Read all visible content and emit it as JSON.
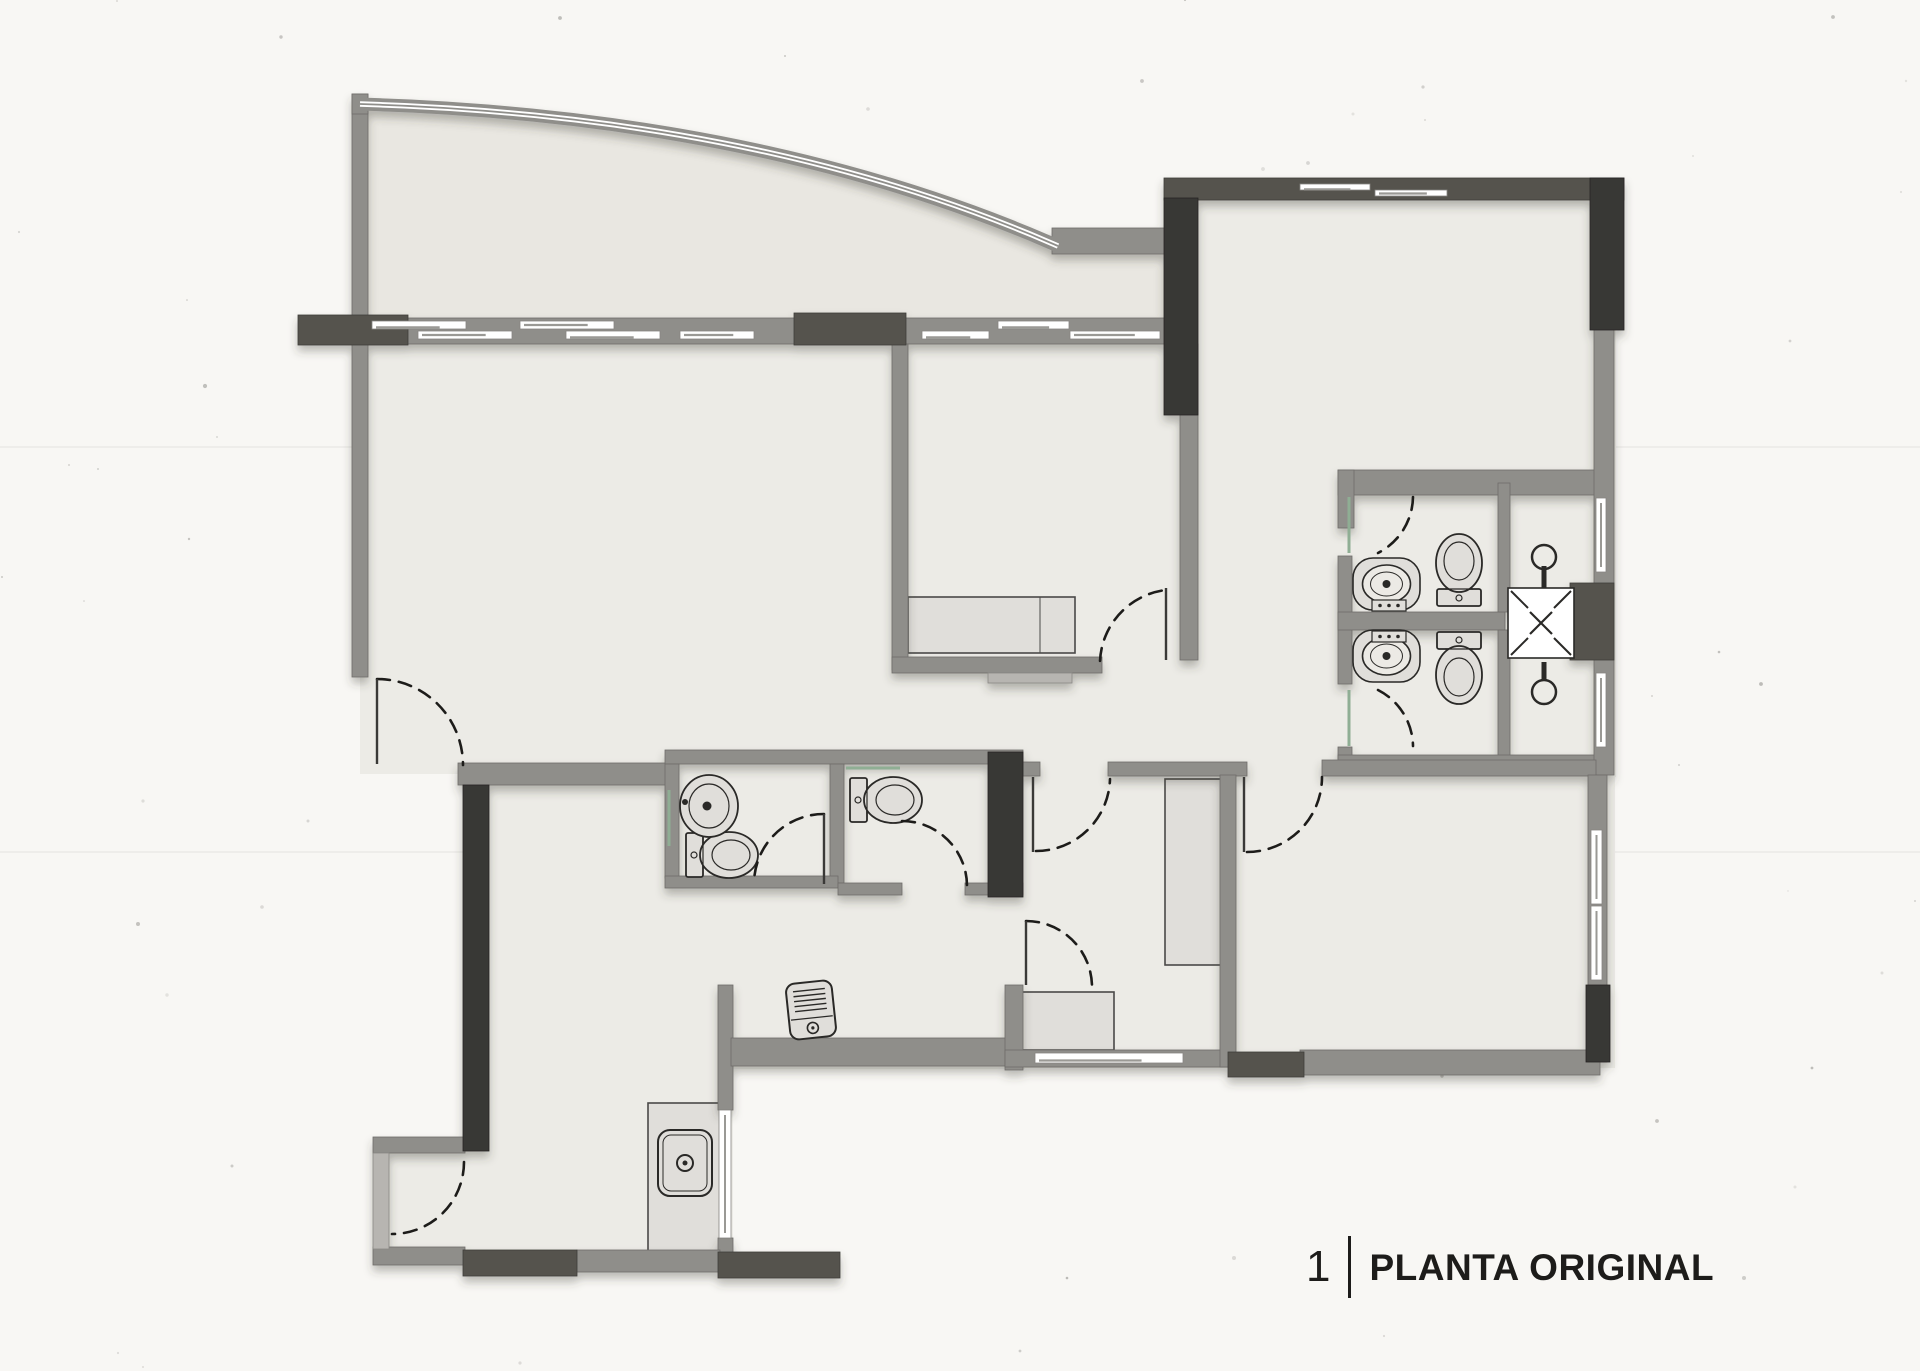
{
  "title": {
    "number": "1",
    "label": "PLANTA ORIGINAL"
  },
  "palette": {
    "paper": "#f8f7f4",
    "floor": "#ecebe6",
    "floor2": "#e9e7e1",
    "wallMid": "#8f8e8a",
    "wallLight": "#b7b5b1",
    "wallDark": "#54524e",
    "wallXDark": "#393834",
    "ink": "#2a2927",
    "furn": "#e0deda",
    "furnLine": "#4a4948",
    "glass": "#8fae94",
    "white": "#ffffff"
  },
  "texture": {
    "speckles": 90,
    "seed": 7,
    "streak_ys": [
      447,
      852
    ]
  },
  "plan": {
    "floors": {
      "terrace_path": "M 360,102 Q 762,114 1056,244 L 1164,244 L 1164,344 L 360,344 Z",
      "rects": [
        [
          360,
          330,
          840,
          444
        ],
        [
          1164,
          198,
          452,
          302
        ],
        [
          1180,
          480,
          436,
          297
        ],
        [
          465,
          757,
          560,
          312
        ],
        [
          465,
          1060,
          268,
          204
        ],
        [
          1023,
          762,
          592,
          306
        ],
        [
          373,
          1150,
          100,
          104
        ]
      ]
    },
    "curve": {
      "band": "M 360,104 Q 762,116 1058,246",
      "cap": [
        352,
        94,
        16,
        20
      ]
    },
    "walls": {
      "mid": [
        [
          352,
          94,
          16,
          230
        ],
        [
          1052,
          228,
          114,
          26
        ],
        [
          300,
          318,
          896,
          26
        ],
        [
          352,
          344,
          16,
          333
        ],
        [
          1180,
          344,
          18,
          316
        ],
        [
          1338,
          470,
          258,
          25
        ],
        [
          1338,
          470,
          16,
          58
        ],
        [
          1338,
          556,
          14,
          128
        ],
        [
          1338,
          747,
          14,
          12
        ],
        [
          1338,
          612,
          167,
          18
        ],
        [
          1498,
          483,
          12,
          129
        ],
        [
          1498,
          630,
          12,
          127
        ],
        [
          1338,
          755,
          268,
          20
        ],
        [
          1594,
          328,
          20,
          447
        ],
        [
          892,
          344,
          16,
          326
        ],
        [
          892,
          657,
          210,
          16
        ],
        [
          1023,
          762,
          17,
          14
        ],
        [
          1108,
          762,
          139,
          14
        ],
        [
          1322,
          760,
          274,
          16
        ],
        [
          458,
          763,
          216,
          22
        ],
        [
          665,
          750,
          358,
          14
        ],
        [
          665,
          764,
          14,
          114
        ],
        [
          830,
          764,
          14,
          119
        ],
        [
          665,
          876,
          173,
          12
        ],
        [
          838,
          883,
          64,
          12
        ],
        [
          965,
          883,
          58,
          12
        ],
        [
          718,
          985,
          15,
          125
        ],
        [
          718,
          1238,
          15,
          20
        ],
        [
          731,
          1038,
          276,
          28
        ],
        [
          1005,
          985,
          18,
          85
        ],
        [
          1005,
          1050,
          230,
          17
        ],
        [
          1220,
          775,
          16,
          292
        ],
        [
          1300,
          1050,
          300,
          25
        ],
        [
          1588,
          775,
          19,
          287
        ],
        [
          373,
          1137,
          92,
          16
        ],
        [
          373,
          1247,
          92,
          18
        ],
        [
          577,
          1250,
          143,
          22
        ]
      ],
      "light": [
        [
          373,
          1153,
          16,
          96
        ],
        [
          988,
          673,
          84,
          10
        ]
      ],
      "dark": [
        [
          1164,
          178,
          460,
          22
        ],
        [
          298,
          315,
          110,
          30
        ],
        [
          794,
          313,
          112,
          32
        ],
        [
          463,
          1250,
          114,
          26
        ],
        [
          718,
          1252,
          122,
          26
        ],
        [
          1228,
          1052,
          76,
          25
        ],
        [
          1570,
          583,
          44,
          77
        ]
      ],
      "xdark": [
        [
          1164,
          198,
          34,
          217
        ],
        [
          1590,
          178,
          34,
          152
        ],
        [
          988,
          752,
          35,
          145
        ],
        [
          463,
          785,
          26,
          366
        ],
        [
          1586,
          985,
          24,
          77
        ]
      ]
    },
    "windows": {
      "horizontal": [
        [
          372,
          321,
          94,
          8
        ],
        [
          520,
          321,
          94,
          8
        ],
        [
          998,
          321,
          71,
          8
        ],
        [
          418,
          331,
          94,
          8
        ],
        [
          566,
          331,
          94,
          8
        ],
        [
          680,
          331,
          74,
          8
        ],
        [
          922,
          331,
          67,
          8
        ],
        [
          1070,
          331,
          90,
          8
        ],
        [
          1300,
          184,
          70,
          6
        ],
        [
          1375,
          190,
          72,
          6
        ],
        [
          1035,
          1053,
          148,
          10
        ]
      ],
      "vertical": [
        [
          1596,
          498,
          10,
          74
        ],
        [
          1596,
          673,
          10,
          74
        ],
        [
          1591,
          830,
          11,
          74
        ],
        [
          1591,
          906,
          11,
          74
        ],
        [
          719,
          1110,
          12,
          128
        ]
      ]
    },
    "glass_lines": [
      [
        1349,
        497,
        1349,
        553
      ],
      [
        1349,
        690,
        1349,
        746
      ],
      [
        669,
        790,
        669,
        846
      ],
      [
        846,
        768,
        900,
        768
      ]
    ],
    "door_arcs": [
      "M 377,679 A 86 86 0 0 1 463,765",
      "M 1100,661 A 75 75 0 0 1 1166,590",
      "M 1413,497 A 64 64 0 0 1 1378,553",
      "M 1378,690 A 64 64 0 0 1 1413,746",
      "M 824,814 A 70 70 0 0 0 754,884",
      "M 902,821 A 65 65 0 0 1 967,886",
      "M 1036,851 A 74 74 0 0 0 1110,779",
      "M 1026,921 A 66 66 0 0 1 1092,987",
      "M 1247,852 A 75 75 0 0 0 1322,777",
      "M 464,1162 A 72 72 0 0 1 392,1234"
    ],
    "door_leaves": [
      [
        377,
        679,
        377,
        764
      ],
      [
        1166,
        588,
        1166,
        660
      ],
      [
        824,
        814,
        824,
        884
      ],
      [
        1033,
        777,
        1033,
        852
      ],
      [
        1026,
        921,
        1026,
        985
      ],
      [
        1244,
        777,
        1244,
        852
      ]
    ],
    "furniture": {
      "counters": [
        {
          "x": 908,
          "y": 597,
          "w": 167,
          "h": 56,
          "divider": 1040
        },
        {
          "x": 1165,
          "y": 779,
          "w": 57,
          "h": 186
        },
        {
          "x": 1022,
          "y": 992,
          "w": 92,
          "h": 58
        },
        {
          "x": 648,
          "y": 1103,
          "w": 72,
          "h": 152
        }
      ]
    },
    "fixtures": {
      "toilets": [
        {
          "cx": 722,
          "cy": 855,
          "rot": 0
        },
        {
          "cx": 886,
          "cy": 800,
          "rot": 0
        },
        {
          "cx": 1459,
          "cy": 570,
          "rot": -90
        },
        {
          "cx": 1459,
          "cy": 668,
          "rot": 90
        }
      ],
      "vanities": [
        {
          "x": 1353,
          "y": 558,
          "w": 67,
          "h": 52,
          "basinY": 584,
          "trayY": 600
        },
        {
          "x": 1353,
          "y": 630,
          "w": 67,
          "h": 52,
          "basinY": 656,
          "trayY": 631
        }
      ],
      "oval_sink": {
        "cx": 709,
        "cy": 806,
        "rx": 29,
        "ry": 31
      },
      "shower_heads": [
        {
          "x": 1544,
          "circleY": 557,
          "stem": [
            566,
            588
          ]
        },
        {
          "x": 1544,
          "circleY": 692,
          "stem": [
            662,
            680
          ]
        }
      ],
      "shaft": {
        "x": 1508,
        "y": 588,
        "w": 66,
        "h": 70
      },
      "kitchen_sink": {
        "x": 658,
        "y": 1130,
        "w": 54,
        "h": 66,
        "drainX": 685,
        "drainY": 1163
      },
      "appliance": {
        "x": 788,
        "y": 982,
        "w": 46,
        "h": 56,
        "rot": -6
      }
    }
  }
}
